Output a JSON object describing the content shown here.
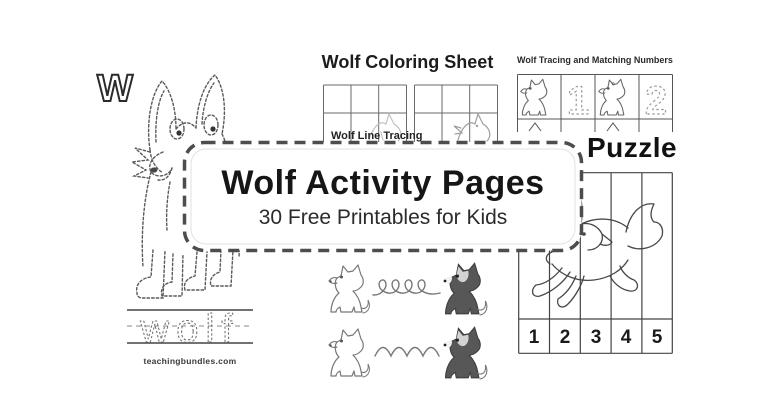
{
  "banner": {
    "title": "Wolf Activity Pages",
    "subtitle": "30 Free Printables for Kids"
  },
  "sheets": {
    "letter_tracing": {
      "letter": "W",
      "trace_word": "wolf",
      "website": "teachingbundles.com"
    },
    "coloring": {
      "title": "Wolf Coloring Sheet"
    },
    "line_tracing": {
      "title": "Wolf Line Tracing"
    },
    "matching_numbers": {
      "title": "Wolf Tracing and Matching Numbers",
      "numbers": [
        "1",
        "2"
      ]
    },
    "puzzle": {
      "title": "Puzzle",
      "numbers": [
        "1",
        "2",
        "3",
        "4",
        "5"
      ]
    }
  },
  "colors": {
    "background": "#ffffff",
    "banner_border": "#4d4d4d",
    "text_primary": "#161616",
    "trace_gray": "#9c9c9c",
    "dark_wolf": "#575757"
  }
}
